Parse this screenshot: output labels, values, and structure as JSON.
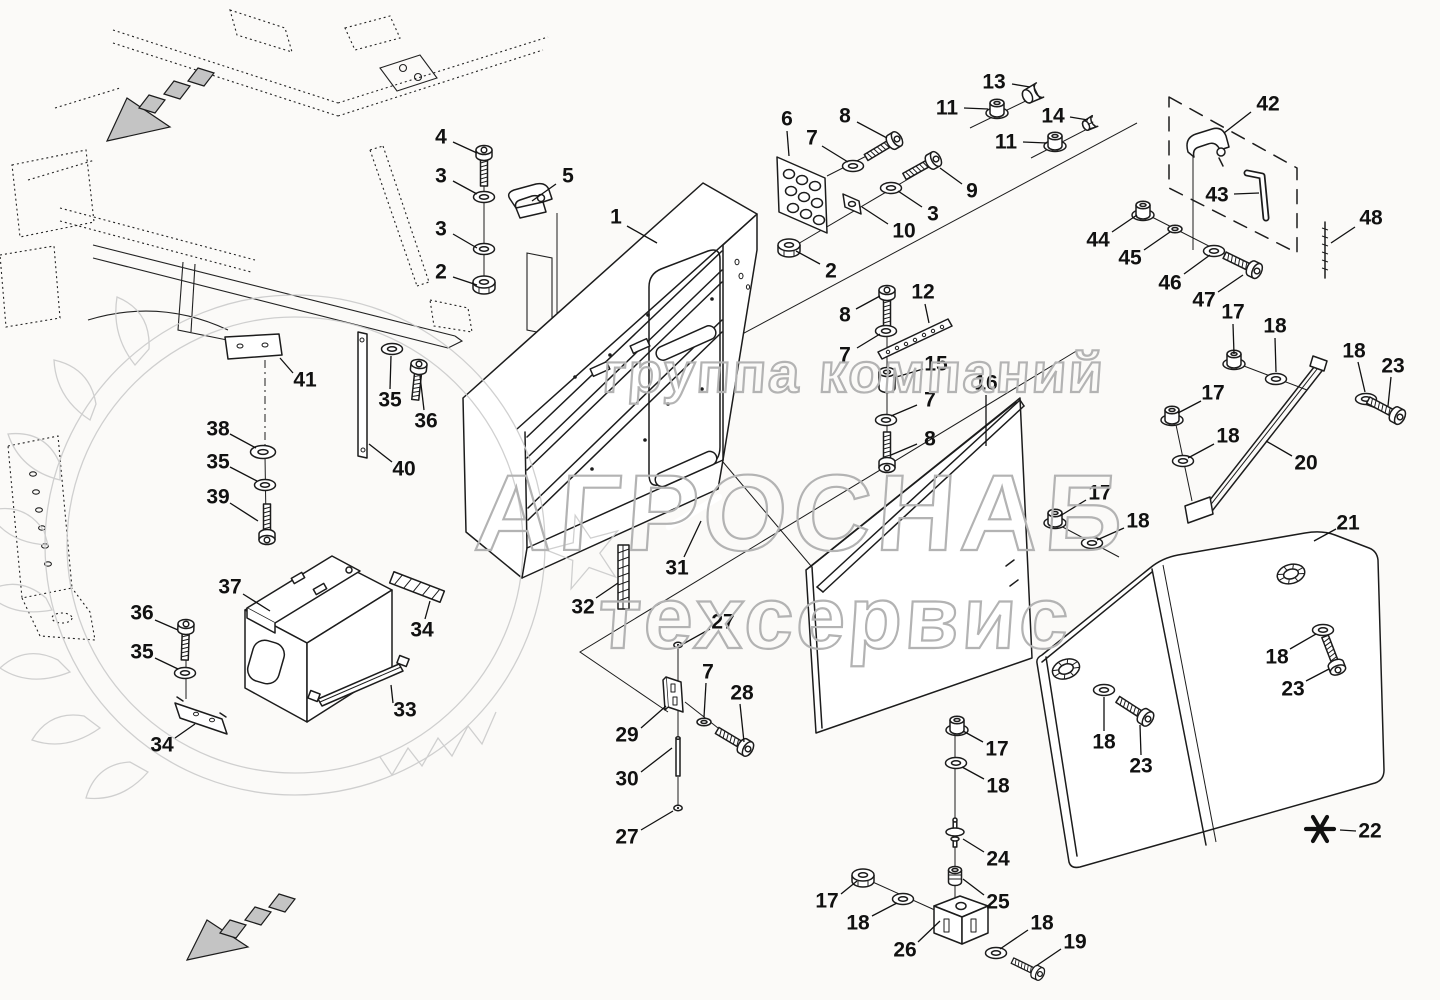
{
  "canvas": {
    "width": 1440,
    "height": 1000,
    "background": "#fbfaf8"
  },
  "style": {
    "ink": "#1c1c1c",
    "watermark_color": "#b3b3b3",
    "wreath_color": "#cbcbcb",
    "arrow_fill": "#c4c4c4"
  },
  "watermark": {
    "line1": "группа компаний",
    "line2": "АГРОСНАБ",
    "line3": "техсервис"
  },
  "footnote": {
    "symbol": "✱",
    "ref": "22"
  },
  "callouts": [
    {
      "t": "4",
      "x": 441,
      "y": 137,
      "l": [
        453,
        142,
        477,
        153
      ]
    },
    {
      "t": "3",
      "x": 441,
      "y": 176,
      "l": [
        453,
        181,
        477,
        194
      ]
    },
    {
      "t": "3",
      "x": 441,
      "y": 229,
      "l": [
        453,
        234,
        477,
        248
      ]
    },
    {
      "t": "2",
      "x": 441,
      "y": 272,
      "l": [
        453,
        277,
        477,
        285
      ]
    },
    {
      "t": "5",
      "x": 568,
      "y": 176,
      "l": [
        556,
        184,
        532,
        201
      ]
    },
    {
      "t": "1",
      "x": 616,
      "y": 217,
      "l": [
        627,
        226,
        657,
        243
      ]
    },
    {
      "t": "6",
      "x": 787,
      "y": 119,
      "l": [
        787,
        131,
        789,
        156
      ]
    },
    {
      "t": "7",
      "x": 812,
      "y": 138,
      "l": [
        822,
        146,
        848,
        162
      ]
    },
    {
      "t": "8",
      "x": 845,
      "y": 116,
      "l": [
        857,
        122,
        887,
        138
      ]
    },
    {
      "t": "13",
      "x": 994,
      "y": 82,
      "l": [
        1012,
        84,
        1030,
        87
      ]
    },
    {
      "t": "11",
      "x": 947,
      "y": 108,
      "l": [
        964,
        108,
        988,
        109
      ]
    },
    {
      "t": "14",
      "x": 1053,
      "y": 116,
      "l": [
        1070,
        117,
        1088,
        120
      ]
    },
    {
      "t": "11",
      "x": 1006,
      "y": 142,
      "l": [
        1023,
        142,
        1047,
        143
      ]
    },
    {
      "t": "9",
      "x": 972,
      "y": 191,
      "l": [
        962,
        184,
        940,
        168
      ]
    },
    {
      "t": "3",
      "x": 933,
      "y": 214,
      "l": [
        922,
        207,
        898,
        191
      ]
    },
    {
      "t": "10",
      "x": 904,
      "y": 231,
      "l": [
        888,
        224,
        862,
        207
      ]
    },
    {
      "t": "2",
      "x": 831,
      "y": 271,
      "l": [
        820,
        264,
        796,
        251
      ]
    },
    {
      "t": "42",
      "x": 1268,
      "y": 104,
      "l": [
        1251,
        112,
        1224,
        133
      ]
    },
    {
      "t": "43",
      "x": 1217,
      "y": 195,
      "l": [
        1234,
        194,
        1259,
        193
      ]
    },
    {
      "t": "48",
      "x": 1371,
      "y": 218,
      "l": [
        1355,
        227,
        1331,
        243
      ]
    },
    {
      "t": "44",
      "x": 1098,
      "y": 240,
      "l": [
        1112,
        232,
        1137,
        215
      ]
    },
    {
      "t": "45",
      "x": 1130,
      "y": 258,
      "l": [
        1144,
        250,
        1170,
        232
      ]
    },
    {
      "t": "46",
      "x": 1170,
      "y": 283,
      "l": [
        1184,
        274,
        1210,
        255
      ]
    },
    {
      "t": "47",
      "x": 1204,
      "y": 300,
      "l": [
        1218,
        292,
        1243,
        275
      ]
    },
    {
      "t": "17",
      "x": 1233,
      "y": 312,
      "l": [
        1233,
        324,
        1234,
        354
      ]
    },
    {
      "t": "18",
      "x": 1275,
      "y": 326,
      "l": [
        1275,
        338,
        1276,
        372
      ]
    },
    {
      "t": "18",
      "x": 1354,
      "y": 351,
      "l": [
        1358,
        362,
        1365,
        392
      ]
    },
    {
      "t": "23",
      "x": 1393,
      "y": 366,
      "l": [
        1391,
        377,
        1388,
        406
      ]
    },
    {
      "t": "17",
      "x": 1213,
      "y": 393,
      "l": [
        1201,
        401,
        1178,
        413
      ]
    },
    {
      "t": "18",
      "x": 1228,
      "y": 436,
      "l": [
        1214,
        444,
        1188,
        458
      ]
    },
    {
      "t": "20",
      "x": 1306,
      "y": 463,
      "l": [
        1292,
        456,
        1266,
        441
      ]
    },
    {
      "t": "17",
      "x": 1100,
      "y": 493,
      "l": [
        1086,
        500,
        1060,
        516
      ]
    },
    {
      "t": "18",
      "x": 1138,
      "y": 521,
      "l": [
        1124,
        528,
        1097,
        540
      ]
    },
    {
      "t": "21",
      "x": 1348,
      "y": 523,
      "l": [
        1336,
        529,
        1314,
        541
      ]
    },
    {
      "t": "8",
      "x": 845,
      "y": 315,
      "l": [
        856,
        309,
        880,
        296
      ]
    },
    {
      "t": "7",
      "x": 845,
      "y": 355,
      "l": [
        857,
        348,
        880,
        334
      ]
    },
    {
      "t": "12",
      "x": 923,
      "y": 292,
      "l": [
        925,
        304,
        929,
        323
      ]
    },
    {
      "t": "15",
      "x": 936,
      "y": 364,
      "l": [
        923,
        369,
        893,
        378
      ]
    },
    {
      "t": "7",
      "x": 930,
      "y": 400,
      "l": [
        917,
        405,
        891,
        416
      ]
    },
    {
      "t": "8",
      "x": 930,
      "y": 439,
      "l": [
        917,
        444,
        891,
        455
      ]
    },
    {
      "t": "16",
      "x": 986,
      "y": 383,
      "l": [
        986,
        395,
        986,
        446
      ]
    },
    {
      "t": "31",
      "x": 677,
      "y": 568,
      "l": [
        684,
        557,
        701,
        521
      ]
    },
    {
      "t": "32",
      "x": 583,
      "y": 607,
      "l": [
        596,
        598,
        618,
        583
      ]
    },
    {
      "t": "27",
      "x": 723,
      "y": 622,
      "l": [
        710,
        629,
        683,
        644
      ]
    },
    {
      "t": "7",
      "x": 708,
      "y": 672,
      "l": [
        706,
        683,
        704,
        717
      ]
    },
    {
      "t": "28",
      "x": 742,
      "y": 693,
      "l": [
        740,
        704,
        744,
        742
      ]
    },
    {
      "t": "29",
      "x": 627,
      "y": 735,
      "l": [
        641,
        728,
        666,
        706
      ]
    },
    {
      "t": "30",
      "x": 627,
      "y": 779,
      "l": [
        641,
        772,
        672,
        748
      ]
    },
    {
      "t": "27",
      "x": 627,
      "y": 837,
      "l": [
        641,
        830,
        673,
        811
      ]
    },
    {
      "t": "17",
      "x": 997,
      "y": 749,
      "l": [
        983,
        742,
        963,
        731
      ]
    },
    {
      "t": "18",
      "x": 998,
      "y": 786,
      "l": [
        984,
        779,
        962,
        767
      ]
    },
    {
      "t": "24",
      "x": 998,
      "y": 859,
      "l": [
        984,
        852,
        963,
        839
      ]
    },
    {
      "t": "25",
      "x": 998,
      "y": 902,
      "l": [
        984,
        895,
        963,
        879
      ]
    },
    {
      "t": "26",
      "x": 905,
      "y": 950,
      "l": [
        918,
        942,
        940,
        921
      ]
    },
    {
      "t": "17",
      "x": 827,
      "y": 901,
      "l": [
        841,
        894,
        857,
        881
      ]
    },
    {
      "t": "18",
      "x": 858,
      "y": 923,
      "l": [
        872,
        916,
        897,
        903
      ]
    },
    {
      "t": "18",
      "x": 1042,
      "y": 923,
      "l": [
        1028,
        930,
        1000,
        949
      ]
    },
    {
      "t": "19",
      "x": 1075,
      "y": 942,
      "l": [
        1061,
        949,
        1036,
        966
      ]
    },
    {
      "t": "18",
      "x": 1104,
      "y": 742,
      "l": [
        1104,
        731,
        1104,
        697
      ]
    },
    {
      "t": "23",
      "x": 1141,
      "y": 766,
      "l": [
        1141,
        755,
        1140,
        725
      ]
    },
    {
      "t": "18",
      "x": 1277,
      "y": 657,
      "l": [
        1290,
        649,
        1316,
        634
      ]
    },
    {
      "t": "23",
      "x": 1293,
      "y": 689,
      "l": [
        1306,
        681,
        1329,
        669
      ]
    },
    {
      "t": "22",
      "x": 1370,
      "y": 831,
      "l": [
        1356,
        831,
        1340,
        830
      ]
    },
    {
      "t": "37",
      "x": 230,
      "y": 587,
      "l": [
        243,
        594,
        270,
        611
      ]
    },
    {
      "t": "41",
      "x": 305,
      "y": 380,
      "l": [
        293,
        373,
        280,
        358
      ]
    },
    {
      "t": "38",
      "x": 218,
      "y": 429,
      "l": [
        230,
        434,
        256,
        448
      ]
    },
    {
      "t": "35",
      "x": 218,
      "y": 462,
      "l": [
        230,
        467,
        257,
        481
      ]
    },
    {
      "t": "39",
      "x": 218,
      "y": 497,
      "l": [
        230,
        503,
        258,
        521
      ]
    },
    {
      "t": "35",
      "x": 390,
      "y": 400,
      "l": [
        390,
        389,
        391,
        356
      ]
    },
    {
      "t": "36",
      "x": 426,
      "y": 421,
      "l": [
        424,
        410,
        420,
        376
      ]
    },
    {
      "t": "40",
      "x": 404,
      "y": 469,
      "l": [
        392,
        462,
        369,
        444
      ]
    },
    {
      "t": "34",
      "x": 422,
      "y": 630,
      "l": [
        425,
        619,
        430,
        601
      ]
    },
    {
      "t": "33",
      "x": 405,
      "y": 710,
      "l": [
        393,
        703,
        391,
        685
      ]
    },
    {
      "t": "36",
      "x": 142,
      "y": 613,
      "l": [
        155,
        620,
        178,
        630
      ]
    },
    {
      "t": "35",
      "x": 142,
      "y": 652,
      "l": [
        155,
        658,
        178,
        669
      ]
    },
    {
      "t": "34",
      "x": 162,
      "y": 745,
      "l": [
        175,
        738,
        195,
        724
      ]
    }
  ],
  "fasteners": [
    {
      "t": "bolt_v",
      "x": 484,
      "y": 150
    },
    {
      "t": "washer",
      "x": 484,
      "y": 197
    },
    {
      "t": "washer",
      "x": 484,
      "y": 249
    },
    {
      "t": "nut",
      "x": 484,
      "y": 284
    },
    {
      "t": "washer",
      "x": 853,
      "y": 166
    },
    {
      "t": "bolt_h",
      "x": 897,
      "y": 139,
      "r": -31
    },
    {
      "t": "bolt_h",
      "x": 936,
      "y": 159,
      "r": -29
    },
    {
      "t": "washer",
      "x": 891,
      "y": 188
    },
    {
      "t": "nut",
      "x": 789,
      "y": 247
    },
    {
      "t": "cap",
      "x": 1040,
      "y": 90,
      "r": -27
    },
    {
      "t": "flange_nut",
      "x": 997,
      "y": 110
    },
    {
      "t": "plug",
      "x": 1095,
      "y": 121,
      "r": -27
    },
    {
      "t": "flange_nut",
      "x": 1055,
      "y": 143
    },
    {
      "t": "flange_nut",
      "x": 1143,
      "y": 212
    },
    {
      "t": "washer_s",
      "x": 1175,
      "y": 229
    },
    {
      "t": "washer",
      "x": 1214,
      "y": 251
    },
    {
      "t": "bolt_h",
      "x": 1257,
      "y": 271,
      "r": 26
    },
    {
      "t": "flange_nut",
      "x": 1234,
      "y": 361
    },
    {
      "t": "washer",
      "x": 1276,
      "y": 379
    },
    {
      "t": "washer",
      "x": 1366,
      "y": 399
    },
    {
      "t": "bolt_h",
      "x": 1400,
      "y": 417,
      "r": 28
    },
    {
      "t": "flange_nut",
      "x": 1172,
      "y": 417
    },
    {
      "t": "washer",
      "x": 1183,
      "y": 461
    },
    {
      "t": "flange_nut",
      "x": 1055,
      "y": 520
    },
    {
      "t": "washer",
      "x": 1092,
      "y": 543
    },
    {
      "t": "bolt_v",
      "x": 887,
      "y": 290
    },
    {
      "t": "washer",
      "x": 886,
      "y": 331
    },
    {
      "t": "spacer",
      "x": 887,
      "y": 380
    },
    {
      "t": "washer",
      "x": 886,
      "y": 420
    },
    {
      "t": "bolt_v",
      "x": 887,
      "y": 468,
      "r": 180
    },
    {
      "t": "knob",
      "x": 1066,
      "y": 669,
      "r": -20
    },
    {
      "t": "washer",
      "x": 1104,
      "y": 690
    },
    {
      "t": "bolt_h",
      "x": 1148,
      "y": 719,
      "r": 33
    },
    {
      "t": "knob",
      "x": 1291,
      "y": 574,
      "r": -15
    },
    {
      "t": "washer",
      "x": 1323,
      "y": 630
    },
    {
      "t": "bolt_h",
      "x": 1338,
      "y": 670,
      "r": 69
    },
    {
      "t": "dot",
      "x": 678,
      "y": 645
    },
    {
      "t": "washer_s",
      "x": 704,
      "y": 722
    },
    {
      "t": "bolt_h",
      "x": 748,
      "y": 749,
      "r": 31
    },
    {
      "t": "pin30",
      "x": 678,
      "y": 757
    },
    {
      "t": "dot",
      "x": 678,
      "y": 808
    },
    {
      "t": "flange_nut",
      "x": 957,
      "y": 727
    },
    {
      "t": "washer",
      "x": 956,
      "y": 763
    },
    {
      "t": "pin24",
      "x": 955,
      "y": 833
    },
    {
      "t": "bush",
      "x": 955,
      "y": 876
    },
    {
      "t": "nut",
      "x": 863,
      "y": 877
    },
    {
      "t": "washer",
      "x": 903,
      "y": 899
    },
    {
      "t": "washer",
      "x": 996,
      "y": 953
    },
    {
      "t": "bolt_h",
      "x": 1040,
      "y": 974,
      "r": 26,
      "s": 0.85
    },
    {
      "t": "washer",
      "x": 392,
      "y": 349
    },
    {
      "t": "bolt_v",
      "x": 419,
      "y": 364,
      "r": 6
    },
    {
      "t": "washer_l",
      "x": 263,
      "y": 452
    },
    {
      "t": "washer",
      "x": 265,
      "y": 485
    },
    {
      "t": "bolt_v",
      "x": 267,
      "y": 540,
      "r": 180
    },
    {
      "t": "bolt_v",
      "x": 186,
      "y": 624,
      "r": 2
    },
    {
      "t": "washer",
      "x": 185,
      "y": 673
    }
  ]
}
